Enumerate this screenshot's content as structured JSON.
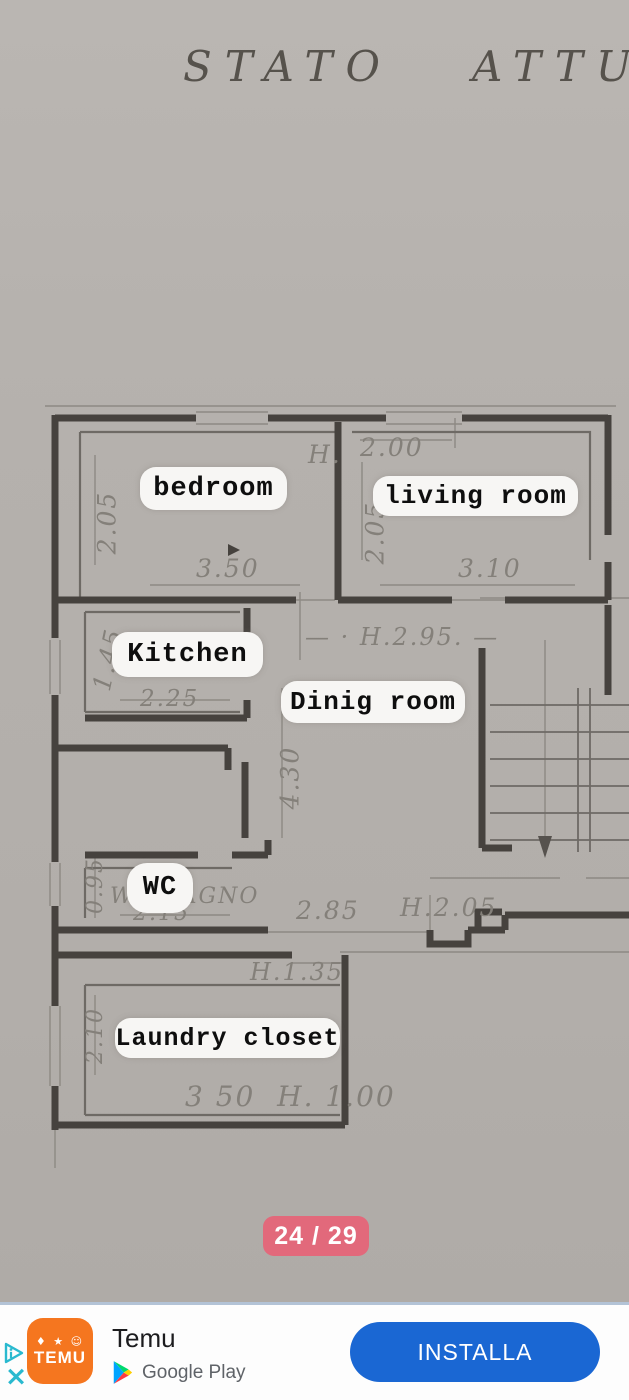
{
  "plan": {
    "title": "STATO   ATTUA",
    "rooms": [
      {
        "label": "bedroom"
      },
      {
        "label": "living room"
      },
      {
        "label": "Kitchen"
      },
      {
        "label": "Dinig room"
      },
      {
        "label": "WC"
      },
      {
        "label": "Laundry closet"
      }
    ],
    "measurements": [
      {
        "text": "2.05"
      },
      {
        "text": "H."
      },
      {
        "text": "2.00"
      },
      {
        "text": "2.05"
      },
      {
        "text": "3.50"
      },
      {
        "text": "3.10"
      },
      {
        "text": "1.45"
      },
      {
        "text": "2.25"
      },
      {
        "text": "— · H.2.95. —"
      },
      {
        "text": "4.30"
      },
      {
        "text": "0.95"
      },
      {
        "text": "WC BAGNO"
      },
      {
        "text": "2.15"
      },
      {
        "text": "2.85"
      },
      {
        "text": "H.2.05"
      },
      {
        "text": "H.1.35"
      },
      {
        "text": "2.10"
      },
      {
        "text": "3 50  H. 1.00"
      }
    ]
  },
  "pager": {
    "label": "24 / 29"
  },
  "ad": {
    "app_name": "Temu",
    "store": "Google Play",
    "cta": "INSTALLA",
    "icon_wordmark": "TEMU",
    "icon_glyphs": "♦ ★ ☺",
    "close": "×"
  },
  "colors": {
    "paper": "#b4b0ac",
    "wall_ink": "#46423e",
    "pencil": "#84807a",
    "pill_bg": "#f7f6f4",
    "badge_bg": "#e2697b",
    "adchoices_teal": "#29b9cf",
    "temu_orange": "#f5761f",
    "install_blue": "#1a67d3",
    "store_text": "#5f6368"
  }
}
